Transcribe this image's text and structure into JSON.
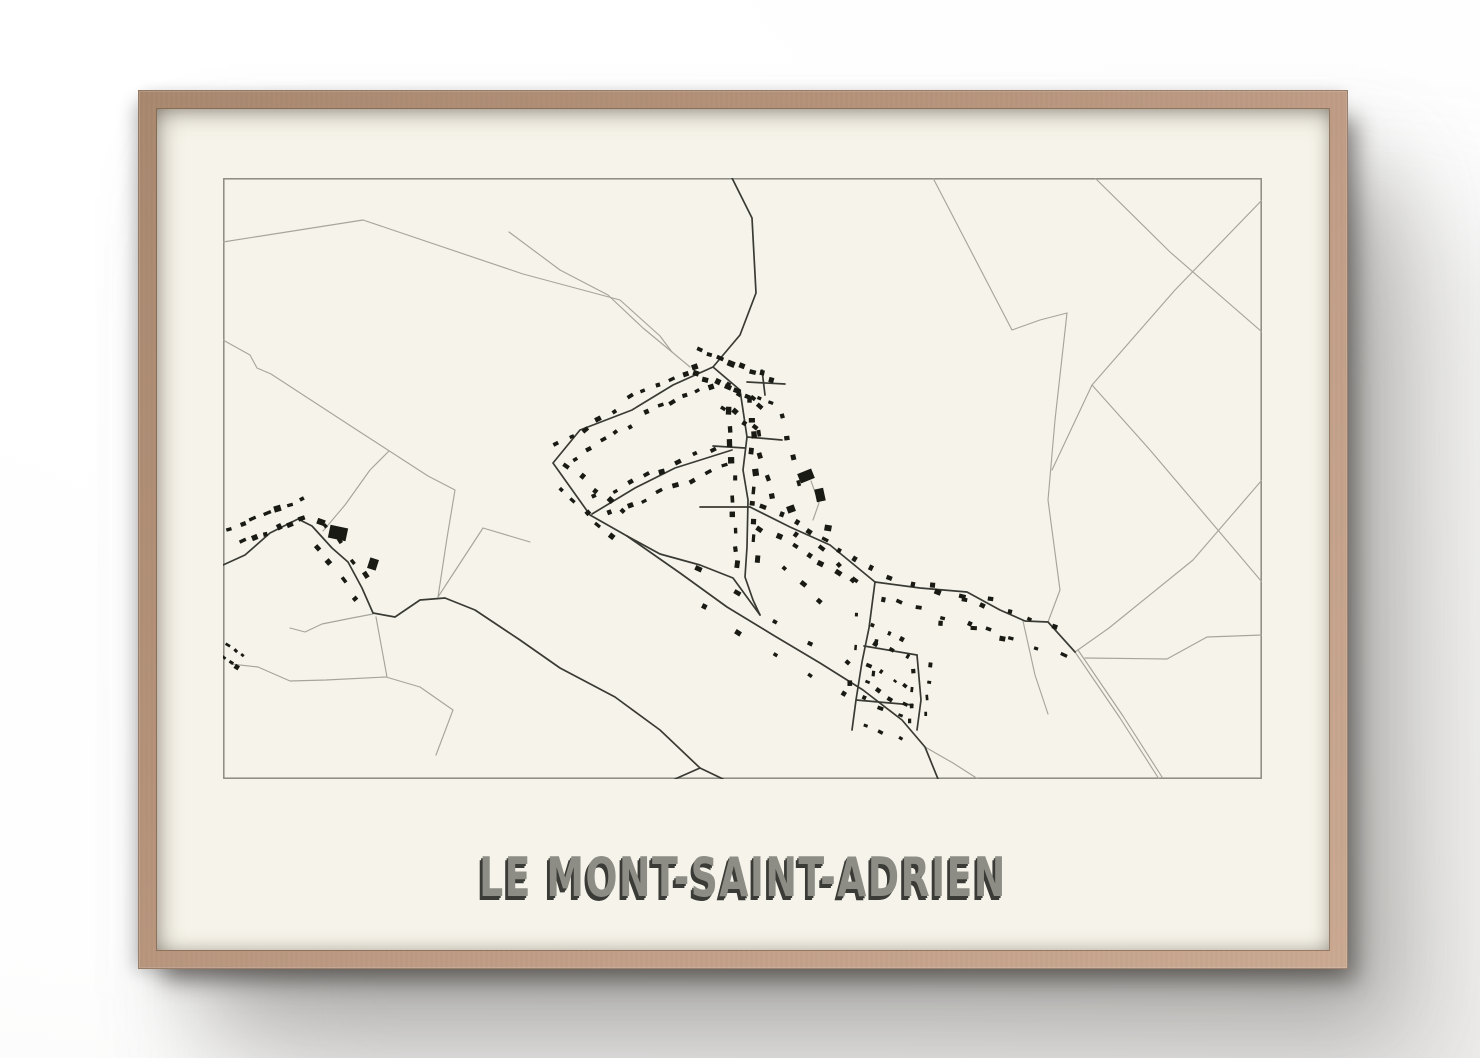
{
  "poster": {
    "title": "LE MONT-SAINT-ADRIEN"
  },
  "colors": {
    "frame_wood": "#b6937b",
    "matte": "#f6f4ea",
    "map_border": "#8a8a82",
    "road_light": "#a6a59c",
    "road_dark": "#3a3a34",
    "building": "#1a1a15",
    "title_fill": "#8d8d86",
    "title_shadow": "#3a3a36"
  },
  "map": {
    "width": 1039,
    "height": 601,
    "roads_light": [
      [
        [
          0,
          64
        ],
        [
          140,
          42
        ],
        [
          300,
          96
        ],
        [
          397,
          122
        ],
        [
          437,
          158
        ],
        [
          449,
          174
        ],
        [
          467,
          189
        ]
      ],
      [
        [
          286,
          54
        ],
        [
          337,
          92
        ],
        [
          385,
          117
        ],
        [
          420,
          150
        ],
        [
          449,
          174
        ]
      ],
      [
        [
          0,
          162
        ],
        [
          27,
          177
        ],
        [
          34,
          190
        ],
        [
          48,
          196
        ],
        [
          137,
          254
        ],
        [
          205,
          298
        ],
        [
          232,
          312
        ],
        [
          224,
          360
        ],
        [
          215,
          419
        ]
      ],
      [
        [
          166,
          273
        ],
        [
          147,
          292
        ],
        [
          122,
          327
        ],
        [
          100,
          353
        ]
      ],
      [
        [
          67,
          450
        ],
        [
          82,
          454
        ],
        [
          99,
          446
        ],
        [
          129,
          440
        ],
        [
          150,
          436
        ]
      ],
      [
        [
          8,
          486
        ],
        [
          35,
          489
        ],
        [
          67,
          503
        ],
        [
          103,
          502
        ],
        [
          163,
          499
        ],
        [
          197,
          509
        ],
        [
          230,
          532
        ],
        [
          213,
          577
        ]
      ],
      [
        [
          153,
          439
        ],
        [
          164,
          499
        ]
      ],
      [
        [
          215,
          419
        ],
        [
          260,
          350
        ],
        [
          307,
          364
        ]
      ],
      [
        [
          588,
          303
        ],
        [
          596,
          325
        ],
        [
          590,
          342
        ]
      ],
      [
        [
          710,
          0
        ],
        [
          789,
          152
        ],
        [
          817,
          142
        ],
        [
          844,
          135
        ]
      ],
      [
        [
          872,
          0
        ],
        [
          947,
          74
        ],
        [
          1039,
          154
        ]
      ],
      [
        [
          844,
          135
        ],
        [
          832,
          242
        ],
        [
          825,
          322
        ],
        [
          837,
          412
        ],
        [
          825,
          444
        ]
      ],
      [
        [
          1039,
          22
        ],
        [
          952,
          112
        ],
        [
          869,
          207
        ],
        [
          829,
          292
        ]
      ],
      [
        [
          869,
          207
        ],
        [
          927,
          272
        ],
        [
          1039,
          404
        ]
      ],
      [
        [
          1039,
          302
        ],
        [
          970,
          382
        ],
        [
          886,
          450
        ],
        [
          852,
          474
        ]
      ],
      [
        [
          862,
          480
        ],
        [
          944,
          481
        ],
        [
          984,
          459
        ],
        [
          1039,
          457
        ]
      ],
      [
        [
          852,
          474
        ],
        [
          897,
          540
        ],
        [
          936,
          601
        ]
      ],
      [
        [
          855,
          472
        ],
        [
          900,
          538
        ],
        [
          939,
          599
        ]
      ],
      [
        [
          800,
          443
        ],
        [
          812,
          497
        ],
        [
          825,
          536
        ]
      ],
      [
        [
          702,
          569
        ],
        [
          730,
          585
        ],
        [
          755,
          601
        ]
      ]
    ],
    "roads_dark": [
      [
        [
          509,
          0
        ],
        [
          529,
          40
        ],
        [
          533,
          115
        ],
        [
          517,
          157
        ],
        [
          490,
          189
        ]
      ],
      [
        [
          490,
          189
        ],
        [
          517,
          212
        ],
        [
          524,
          259
        ],
        [
          520,
          292
        ],
        [
          525,
          322
        ],
        [
          524,
          369
        ],
        [
          522,
          399
        ],
        [
          530,
          422
        ],
        [
          537,
          437
        ]
      ],
      [
        [
          490,
          189
        ],
        [
          450,
          207
        ],
        [
          409,
          232
        ],
        [
          357,
          252
        ],
        [
          330,
          285
        ],
        [
          367,
          337
        ],
        [
          404,
          358
        ]
      ],
      [
        [
          404,
          358
        ],
        [
          457,
          395
        ],
        [
          504,
          429
        ],
        [
          550,
          457
        ],
        [
          597,
          485
        ],
        [
          640,
          512
        ],
        [
          679,
          542
        ],
        [
          702,
          569
        ],
        [
          715,
          601
        ]
      ],
      [
        [
          404,
          358
        ],
        [
          437,
          376
        ],
        [
          477,
          387
        ],
        [
          510,
          400
        ],
        [
          537,
          437
        ]
      ],
      [
        [
          527,
          329
        ],
        [
          567,
          349
        ],
        [
          607,
          367
        ],
        [
          652,
          404
        ]
      ],
      [
        [
          652,
          404
        ],
        [
          697,
          410
        ],
        [
          744,
          414
        ],
        [
          777,
          432
        ],
        [
          802,
          443
        ],
        [
          825,
          444
        ],
        [
          852,
          474
        ]
      ],
      [
        [
          652,
          404
        ],
        [
          646,
          450
        ],
        [
          639,
          484
        ],
        [
          633,
          522
        ],
        [
          629,
          552
        ]
      ],
      [
        [
          641,
          468
        ],
        [
          694,
          477
        ]
      ],
      [
        [
          694,
          477
        ],
        [
          698,
          522
        ],
        [
          694,
          552
        ]
      ],
      [
        [
          633,
          522
        ],
        [
          690,
          527
        ]
      ],
      [
        [
          369,
          336
        ],
        [
          412,
          310
        ],
        [
          452,
          290
        ],
        [
          509,
          272
        ]
      ],
      [
        [
          490,
          268
        ],
        [
          522,
          270
        ]
      ],
      [
        [
          477,
          329
        ],
        [
          527,
          329
        ]
      ],
      [
        [
          524,
          259
        ],
        [
          559,
          262
        ]
      ],
      [
        [
          539,
          192
        ],
        [
          542,
          217
        ]
      ],
      [
        [
          524,
          204
        ],
        [
          562,
          206
        ]
      ],
      [
        [
          0,
          387
        ],
        [
          22,
          377
        ],
        [
          47,
          355
        ],
        [
          75,
          341
        ],
        [
          89,
          348
        ],
        [
          109,
          370
        ],
        [
          125,
          384
        ],
        [
          139,
          410
        ],
        [
          150,
          435
        ],
        [
          172,
          439
        ],
        [
          197,
          422
        ],
        [
          222,
          420
        ],
        [
          252,
          432
        ],
        [
          297,
          462
        ],
        [
          337,
          490
        ],
        [
          392,
          519
        ],
        [
          437,
          552
        ],
        [
          477,
          590
        ],
        [
          452,
          601
        ]
      ],
      [
        [
          477,
          590
        ],
        [
          500,
          601
        ]
      ]
    ],
    "buildings": [
      [
        115,
        355,
        18,
        13,
        12
      ],
      [
        150,
        386,
        9,
        11,
        18
      ],
      [
        98,
        344,
        8,
        6,
        20
      ],
      [
        583,
        298,
        15,
        10,
        -22
      ],
      [
        597,
        317,
        9,
        13,
        -12
      ],
      [
        568,
        331,
        8,
        7,
        -20
      ],
      [
        605,
        350,
        7,
        6,
        10
      ]
    ],
    "building_clusters": [
      {
        "s": [
          6,
          360,
          86,
          330
        ],
        "n": 13,
        "o": 7,
        "j": 4,
        "a": 4,
        "b": 8,
        "seed": 11
      },
      {
        "s": [
          92,
          350,
          143,
          416
        ],
        "n": 8,
        "o": 8,
        "j": 4,
        "a": 4,
        "b": 7,
        "seed": 12
      },
      {
        "s": [
          0,
          470,
          20,
          486
        ],
        "n": 6,
        "o": 4,
        "j": 3,
        "a": 3,
        "b": 6,
        "seed": 13
      },
      {
        "s": [
          470,
          182,
          553,
          214
        ],
        "n": 16,
        "o": 9,
        "j": 6,
        "a": 4,
        "b": 8,
        "seed": 14
      },
      {
        "s": [
          497,
          214,
          540,
          242
        ],
        "n": 8,
        "o": 8,
        "j": 5,
        "a": 4,
        "b": 7,
        "seed": 15
      },
      {
        "s": [
          409,
          230,
          487,
          196
        ],
        "n": 12,
        "o": 8,
        "j": 5,
        "a": 4,
        "b": 7,
        "seed": 16
      },
      {
        "s": [
          336,
          278,
          405,
          236
        ],
        "n": 10,
        "o": 8,
        "j": 5,
        "a": 4,
        "b": 7,
        "seed": 17
      },
      {
        "s": [
          372,
          331,
          503,
          276
        ],
        "n": 16,
        "o": 8,
        "j": 5,
        "a": 4,
        "b": 7,
        "seed": 18
      },
      {
        "s": [
          334,
          292,
          401,
          353
        ],
        "n": 10,
        "o": 9,
        "j": 5,
        "a": 4,
        "b": 7,
        "seed": 19
      },
      {
        "s": [
          518,
          218,
          523,
          392
        ],
        "n": 20,
        "o": 8,
        "j": 5,
        "a": 4,
        "b": 8,
        "seed": 20
      },
      {
        "s": [
          546,
          236,
          566,
          322
        ],
        "n": 8,
        "o": 11,
        "j": 8,
        "a": 4,
        "b": 7,
        "seed": 21
      },
      {
        "s": [
          532,
          335,
          646,
          399
        ],
        "n": 15,
        "o": 8,
        "j": 5,
        "a": 4,
        "b": 7,
        "seed": 22
      },
      {
        "s": [
          658,
          408,
          846,
          466
        ],
        "n": 16,
        "o": 8,
        "j": 6,
        "a": 4,
        "b": 7,
        "seed": 23
      },
      {
        "s": [
          643,
          453,
          689,
          472
        ],
        "n": 6,
        "o": 6,
        "j": 4,
        "a": 3,
        "b": 6,
        "seed": 24
      },
      {
        "s": [
          639,
          493,
          687,
          522
        ],
        "n": 8,
        "o": 6,
        "j": 4,
        "a": 3,
        "b": 6,
        "seed": 25
      },
      {
        "s": [
          699,
          483,
          696,
          546
        ],
        "n": 8,
        "o": 6,
        "j": 4,
        "a": 3,
        "b": 6,
        "seed": 26
      },
      {
        "s": [
          632,
          528,
          687,
          555
        ],
        "n": 6,
        "o": 8,
        "j": 5,
        "a": 3,
        "b": 6,
        "seed": 27
      },
      {
        "s": [
          459,
          399,
          638,
          513
        ],
        "n": 10,
        "o": 10,
        "j": 7,
        "a": 4,
        "b": 7,
        "seed": 28
      },
      {
        "s": [
          649,
          412,
          635,
          518
        ],
        "n": 6,
        "o": 8,
        "j": 5,
        "a": 3,
        "b": 6,
        "seed": 29
      },
      {
        "s": [
          700,
          428,
          788,
          440
        ],
        "n": 6,
        "o": 12,
        "j": 10,
        "a": 4,
        "b": 7,
        "seed": 30
      },
      {
        "s": [
          560,
          362,
          618,
          420
        ],
        "n": 7,
        "o": 12,
        "j": 10,
        "a": 4,
        "b": 7,
        "seed": 31
      }
    ]
  }
}
